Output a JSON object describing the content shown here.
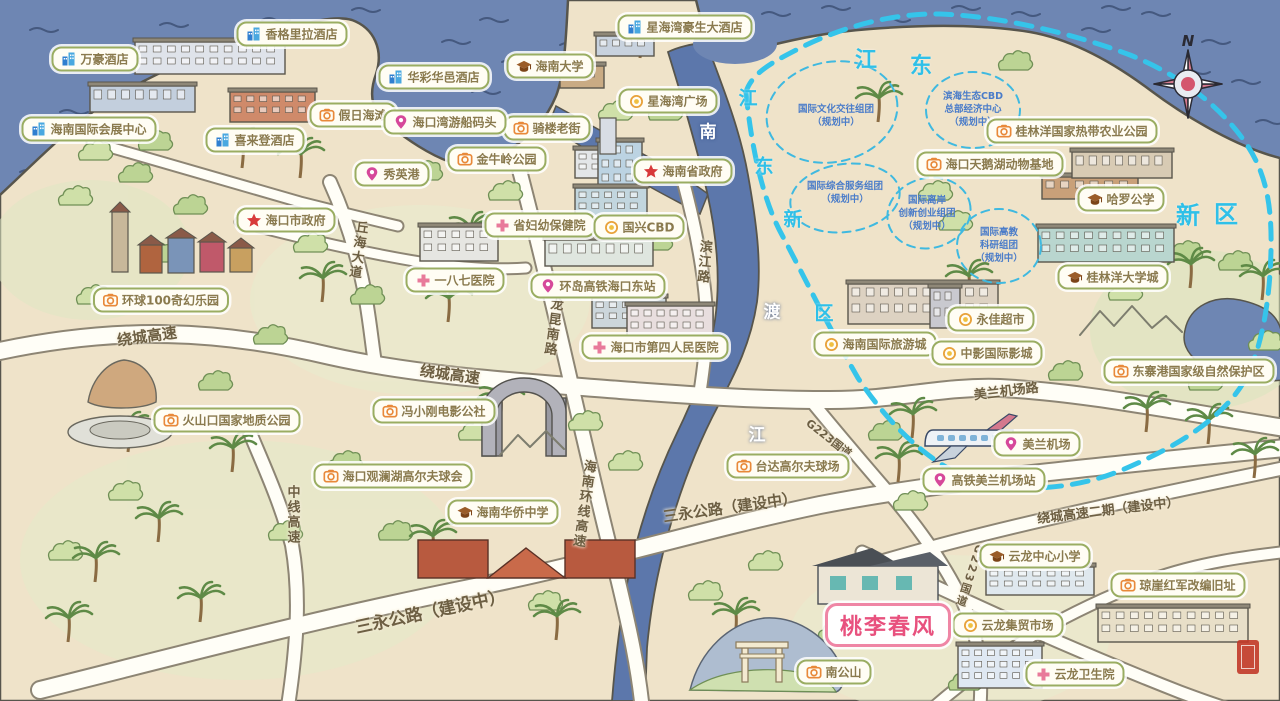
{
  "map": {
    "title": "海口手绘旅游地图",
    "colors": {
      "sea": "#6e86b3",
      "land": "#efe3c9",
      "coast": "#57554c",
      "boundary": "#35c4ea",
      "pill_border": "#9aad62",
      "pill_text": "#8a7a4e",
      "featured_pink": "#e8517e",
      "road_label": "#6d5f43",
      "planning_text": "#4a7cc9",
      "road_fill": "#fffef7"
    },
    "compass": {
      "label": "N"
    },
    "featured": {
      "id": "taoli-chunfeng",
      "label": "桃李春风",
      "x": 888,
      "y": 625
    },
    "pois": [
      {
        "id": "wanhao-hotel",
        "type": "hotel",
        "label": "万豪酒店",
        "x": 95,
        "y": 59
      },
      {
        "id": "shangri-la-hotel",
        "type": "hotel",
        "label": "香格里拉酒店",
        "x": 292,
        "y": 34
      },
      {
        "id": "huacai-huayi-hotel",
        "type": "hotel",
        "label": "华彩华邑酒店",
        "x": 434,
        "y": 77
      },
      {
        "id": "sheraton-hotel",
        "type": "hotel",
        "label": "喜来登酒店",
        "x": 255,
        "y": 140
      },
      {
        "id": "xinghaiwan-haosheng-hotel",
        "type": "hotel",
        "label": "星海湾豪生大酒店",
        "x": 685,
        "y": 27
      },
      {
        "id": "hainan-convention-center",
        "type": "hotel",
        "label": "海南国际会展中心",
        "x": 89,
        "y": 129
      },
      {
        "id": "holiday-beach",
        "type": "camera",
        "label": "假日海滩",
        "x": 353,
        "y": 115
      },
      {
        "id": "qilou-old-street",
        "type": "camera",
        "label": "骑楼老街",
        "x": 547,
        "y": 128
      },
      {
        "id": "jinniuling-park",
        "type": "camera",
        "label": "金牛岭公园",
        "x": 497,
        "y": 159
      },
      {
        "id": "movie-town-100",
        "type": "camera",
        "label": "环球100奇幻乐园",
        "x": 161,
        "y": 300
      },
      {
        "id": "volcano-geopark",
        "type": "camera",
        "label": "火山口国家地质公园",
        "x": 227,
        "y": 420
      },
      {
        "id": "fengxiaogang-movie-commune",
        "type": "camera",
        "label": "冯小刚电影公社",
        "x": 434,
        "y": 411
      },
      {
        "id": "mission-hills-golf",
        "type": "camera",
        "label": "海口观澜湖高尔夫球会",
        "x": 393,
        "y": 476
      },
      {
        "id": "taida-golf",
        "type": "camera",
        "label": "台达高尔夫球场",
        "x": 788,
        "y": 466
      },
      {
        "id": "dongzhaigang-reserve",
        "type": "camera",
        "label": "东寨港国家级自然保护区",
        "x": 1189,
        "y": 371
      },
      {
        "id": "guilinyang-agri-park",
        "type": "camera",
        "label": "桂林洋国家热带农业公园",
        "x": 1072,
        "y": 131
      },
      {
        "id": "swan-lake-animal-base",
        "type": "camera",
        "label": "海口天鹅湖动物基地",
        "x": 990,
        "y": 164
      },
      {
        "id": "qiongya-red-army-site",
        "type": "camera",
        "label": "琼崖红军改编旧址",
        "x": 1178,
        "y": 585
      },
      {
        "id": "nangong-mountain",
        "type": "camera",
        "label": "南公山",
        "x": 834,
        "y": 672
      },
      {
        "id": "hainan-university",
        "type": "school",
        "label": "海南大学",
        "x": 550,
        "y": 66
      },
      {
        "id": "harrow-school",
        "type": "school",
        "label": "哈罗公学",
        "x": 1121,
        "y": 199
      },
      {
        "id": "guilinyang-university-town",
        "type": "school",
        "label": "桂林洋大学城",
        "x": 1113,
        "y": 277
      },
      {
        "id": "hainan-overseas-chinese-school",
        "type": "school",
        "label": "海南华侨中学",
        "x": 503,
        "y": 512
      },
      {
        "id": "yunlong-primary-school",
        "type": "school",
        "label": "云龙中心小学",
        "x": 1035,
        "y": 556
      },
      {
        "id": "haikou-bay-cruise-terminal",
        "type": "pin",
        "label": "海口湾游船码头",
        "x": 445,
        "y": 122
      },
      {
        "id": "xiuying-port",
        "type": "pin",
        "label": "秀英港",
        "x": 392,
        "y": 174
      },
      {
        "id": "haikou-east-station",
        "type": "pin",
        "label": "环岛高铁海口东站",
        "x": 598,
        "y": 286
      },
      {
        "id": "meilan-airport",
        "type": "pin",
        "label": "美兰机场",
        "x": 1037,
        "y": 444
      },
      {
        "id": "meilan-airport-hsr-station",
        "type": "pin",
        "label": "高铁美兰机场站",
        "x": 984,
        "y": 480
      },
      {
        "id": "provincial-government",
        "type": "star",
        "label": "海南省政府",
        "x": 683,
        "y": 171
      },
      {
        "id": "city-government",
        "type": "star",
        "label": "海口市政府",
        "x": 286,
        "y": 220
      },
      {
        "id": "maternal-child-hospital",
        "type": "hospital",
        "label": "省妇幼保健院",
        "x": 540,
        "y": 225
      },
      {
        "id": "hospital-187",
        "type": "hospital",
        "label": "一八七医院",
        "x": 455,
        "y": 280
      },
      {
        "id": "fourth-peoples-hospital",
        "type": "hospital",
        "label": "海口市第四人民医院",
        "x": 655,
        "y": 347
      },
      {
        "id": "yunlong-clinic",
        "type": "hospital",
        "label": "云龙卫生院",
        "x": 1075,
        "y": 674
      },
      {
        "id": "xinghai-bay-plaza",
        "type": "shop",
        "label": "星海湾广场",
        "x": 668,
        "y": 101
      },
      {
        "id": "guoxing-cbd",
        "type": "shop",
        "label": "国兴CBD",
        "x": 639,
        "y": 227
      },
      {
        "id": "hainan-intl-tourism-city",
        "type": "shop",
        "label": "海南国际旅游城",
        "x": 875,
        "y": 344
      },
      {
        "id": "yongjia-supermarket",
        "type": "shop",
        "label": "永佳超市",
        "x": 991,
        "y": 319
      },
      {
        "id": "china-film-cinema",
        "type": "shop",
        "label": "中影国际影城",
        "x": 987,
        "y": 353
      },
      {
        "id": "yunlong-market",
        "type": "shop",
        "label": "云龙集贸市场",
        "x": 1008,
        "y": 625
      }
    ],
    "road_labels": [
      {
        "text": "绕城高速",
        "x": 147,
        "y": 336,
        "angle": -8,
        "size": 15
      },
      {
        "text": "绕城高速",
        "x": 450,
        "y": 374,
        "angle": 8,
        "size": 15
      },
      {
        "text": "三永公路（建设中）",
        "x": 430,
        "y": 610,
        "angle": -12,
        "size": 17
      },
      {
        "text": "三永公路（建设中）",
        "x": 730,
        "y": 507,
        "angle": -8,
        "size": 15
      },
      {
        "text": "绕城高速二期（建设中）",
        "x": 1108,
        "y": 509,
        "angle": -7,
        "size": 13
      },
      {
        "text": "美兰机场路",
        "x": 1006,
        "y": 390,
        "angle": -7,
        "size": 13
      },
      {
        "text": "丘海大道",
        "x": 357,
        "y": 250,
        "vertical": true,
        "angle": 8,
        "size": 13
      },
      {
        "text": "龙昆南路",
        "x": 552,
        "y": 327,
        "vertical": true,
        "angle": 8,
        "size": 13
      },
      {
        "text": "滨江路",
        "x": 703,
        "y": 262,
        "vertical": true,
        "angle": 5,
        "size": 13
      },
      {
        "text": "海南环线高速",
        "x": 583,
        "y": 504,
        "vertical": true,
        "angle": 8,
        "size": 13
      },
      {
        "text": "中线高速",
        "x": 292,
        "y": 515,
        "vertical": true,
        "angle": 0,
        "size": 13
      },
      {
        "text": "G223国道",
        "x": 829,
        "y": 438,
        "angle": 38,
        "size": 11
      },
      {
        "text": "G223国道",
        "x": 969,
        "y": 576,
        "vertical": true,
        "angle": 18,
        "size": 11
      }
    ],
    "district_labels": [
      {
        "text": "江",
        "x": 866,
        "y": 58,
        "size": 22
      },
      {
        "text": "东",
        "x": 921,
        "y": 64,
        "size": 22
      },
      {
        "text": "江",
        "x": 748,
        "y": 97,
        "size": 19
      },
      {
        "text": "东",
        "x": 764,
        "y": 165,
        "size": 19
      },
      {
        "text": "新",
        "x": 793,
        "y": 218,
        "size": 19
      },
      {
        "text": "区",
        "x": 824,
        "y": 312,
        "size": 19
      },
      {
        "text": "新",
        "x": 1188,
        "y": 213,
        "size": 24
      },
      {
        "text": "区",
        "x": 1226,
        "y": 212,
        "size": 24
      }
    ],
    "river_labels": [
      {
        "text": "南",
        "x": 708,
        "y": 130
      },
      {
        "text": "渡",
        "x": 772,
        "y": 310
      },
      {
        "text": "江",
        "x": 757,
        "y": 433
      }
    ],
    "planning_regions": [
      {
        "text": "国际文化交往组团\n（规划中）",
        "x": 836,
        "y": 117
      },
      {
        "text": "滨海生态CBD\n总部经济中心\n（规划中）",
        "x": 973,
        "y": 110
      },
      {
        "text": "国际综合服务组团\n（规划中）",
        "x": 845,
        "y": 194
      },
      {
        "text": "国际离岸\n创新创业组团\n（规划中）",
        "x": 927,
        "y": 214
      },
      {
        "text": "国际高教\n科研组团\n（规划中）",
        "x": 999,
        "y": 246
      }
    ]
  }
}
